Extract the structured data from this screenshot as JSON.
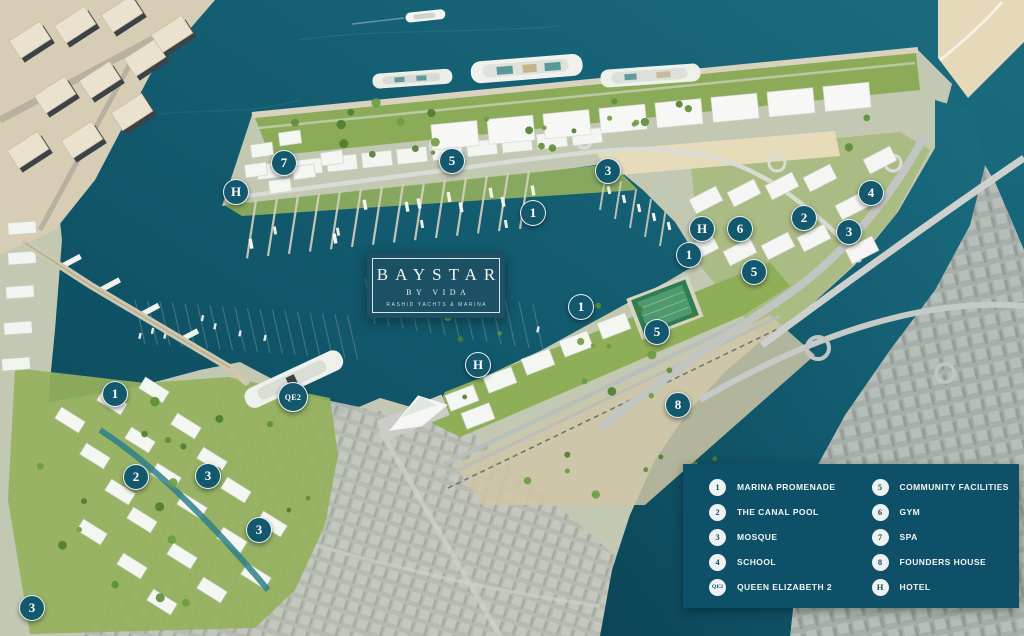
{
  "brand": {
    "title": "BAYSTAR",
    "subtitle": "BY VIDA",
    "tagline": "RASHID YACHTS & MARINA"
  },
  "colors": {
    "marker_bg": "#14586E",
    "marker_border": "#FFFFFF",
    "marker_text": "#FFFFFF",
    "legend_bg": "#0D5068",
    "legend_text": "#F2F6F5",
    "badge_bg": "#EEF2F1",
    "badge_text": "#0D4F66",
    "card_bg": "#1C5064",
    "water": "#11566B"
  },
  "map_markers": [
    {
      "label": "7",
      "x": 284,
      "y": 163
    },
    {
      "label": "H",
      "x": 236,
      "y": 192
    },
    {
      "label": "5",
      "x": 452,
      "y": 161
    },
    {
      "label": "3",
      "x": 608,
      "y": 171
    },
    {
      "label": "1",
      "x": 533,
      "y": 213
    },
    {
      "label": "4",
      "x": 871,
      "y": 193
    },
    {
      "label": "2",
      "x": 804,
      "y": 218
    },
    {
      "label": "3",
      "x": 849,
      "y": 232
    },
    {
      "label": "H",
      "x": 702,
      "y": 229
    },
    {
      "label": "6",
      "x": 740,
      "y": 229
    },
    {
      "label": "1",
      "x": 689,
      "y": 255
    },
    {
      "label": "5",
      "x": 754,
      "y": 272
    },
    {
      "label": "1",
      "x": 581,
      "y": 307
    },
    {
      "label": "5",
      "x": 657,
      "y": 332
    },
    {
      "label": "H",
      "x": 478,
      "y": 365
    },
    {
      "label": "QE2",
      "x": 293,
      "y": 397
    },
    {
      "label": "8",
      "x": 678,
      "y": 405
    },
    {
      "label": "1",
      "x": 115,
      "y": 394
    },
    {
      "label": "2",
      "x": 136,
      "y": 477
    },
    {
      "label": "3",
      "x": 208,
      "y": 476
    },
    {
      "label": "3",
      "x": 259,
      "y": 530
    },
    {
      "label": "3",
      "x": 32,
      "y": 608
    }
  ],
  "legend": {
    "columns": [
      {
        "items": [
          {
            "badge": "1",
            "label": "MARINA PROMENADE"
          },
          {
            "badge": "2",
            "label": "THE CANAL POOL"
          },
          {
            "badge": "3",
            "label": "MOSQUE"
          },
          {
            "badge": "4",
            "label": "SCHOOL"
          },
          {
            "badge": "QE2",
            "label": "QUEEN ELIZABETH 2"
          }
        ]
      },
      {
        "items": [
          {
            "badge": "5",
            "label": "COMMUNITY FACILITIES"
          },
          {
            "badge": "6",
            "label": "GYM"
          },
          {
            "badge": "7",
            "label": "SPA"
          },
          {
            "badge": "8",
            "label": "FOUNDERS HOUSE"
          },
          {
            "badge": "H",
            "label": "HOTEL"
          }
        ]
      }
    ]
  }
}
